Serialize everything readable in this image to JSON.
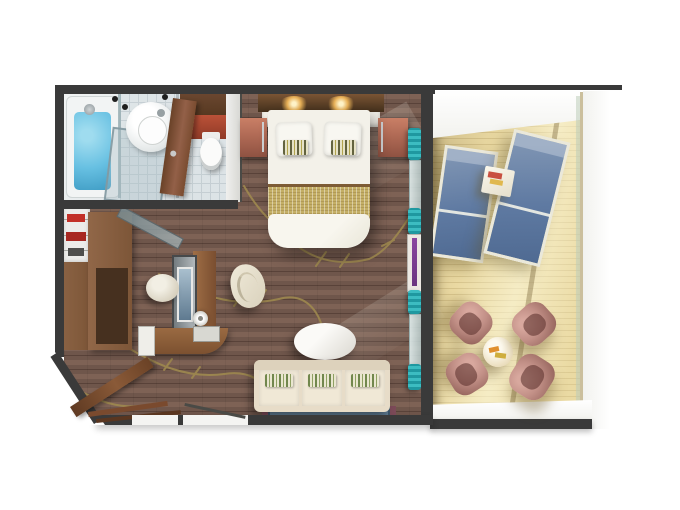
{
  "scene": {
    "description": "3D top-down floor plan render of a balcony suite stateroom",
    "background": "#ffffff"
  },
  "colors": {
    "wall": "#3a3a3a",
    "carpet": "#6f564b",
    "carpet_stripe": "#7e6255",
    "gold_branch": "#a18c4f",
    "bath_floor": "#d5dde0",
    "tub_water": "#67c0e2",
    "wood": "#7d5638",
    "wood_dark": "#54371f",
    "nightstand": "#b06a55",
    "linen": "#f3f1e9",
    "runner": "#c4af66",
    "teal": "#1f98a0",
    "mirror_purple": "#6a3580",
    "deck": "#ead9a2",
    "deck_line": "#d7c48c",
    "lounger": "#5f7aa2",
    "lounger_frame": "#eae8da",
    "mauve": "#c18f86",
    "mauve_dark": "#96655d",
    "cream_table": "#ecdfc0",
    "sofa": "#e7dcc8",
    "sofa_seat": "#f0e8d6",
    "pillow_green": "#71874d",
    "rug": "#5e7a91",
    "rug_border": "#7c4a58",
    "tv_panel": "#b2b8bb",
    "tv_screen": "#5f7a90",
    "ledge": "#f2f2ee",
    "railing": "#cbbf9c"
  },
  "rooms": {
    "bathroom": {
      "furniture": [
        "bathtub",
        "shower-glass",
        "washbasin",
        "toilet",
        "bathroom-door",
        "wood-cabinet",
        "red-cabinet"
      ]
    },
    "bedroom": {
      "furniture": [
        "double-bed",
        "pillows",
        "accent-pillows",
        "bed-runner",
        "nightstand-left",
        "nightstand-right",
        "headboard-shelf",
        "reading-lights"
      ]
    },
    "living_room": {
      "furniture": [
        "shelving-unit",
        "wardrobe",
        "tall-cabinet",
        "tv-panel",
        "desk",
        "desk-return",
        "desk-chair",
        "stool",
        "drawer-unit",
        "table-lamp",
        "coffee-table",
        "sofa",
        "rug",
        "entry-door",
        "curtains",
        "mirror"
      ]
    },
    "balcony": {
      "furniture": [
        "sun-lounger-1",
        "sun-lounger-2",
        "side-table",
        "dining-table",
        "chair-1",
        "chair-2",
        "chair-3",
        "chair-4",
        "glass-railing"
      ]
    }
  }
}
